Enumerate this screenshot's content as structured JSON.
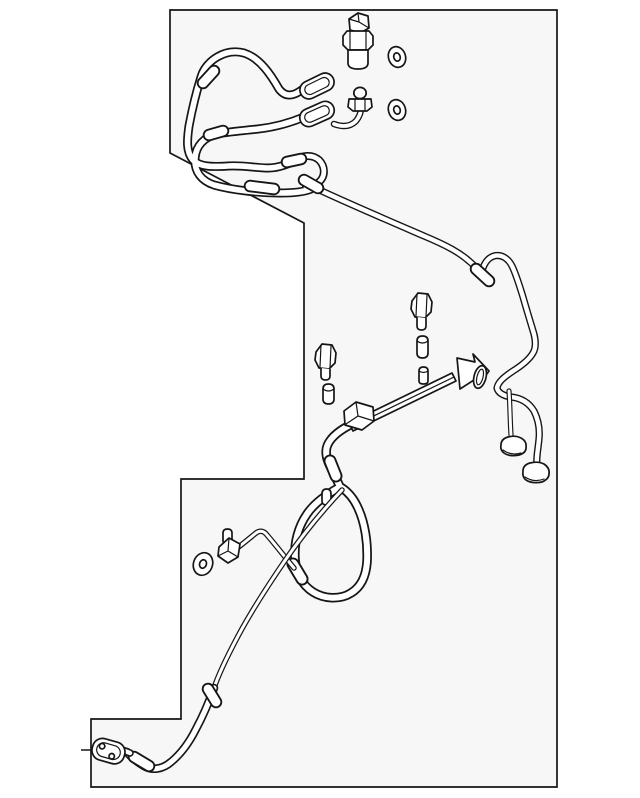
{
  "diagram": {
    "label": "Automotive air-conditioning refrigerant line assembly parts line drawing",
    "kind": "parts-line-drawing",
    "colors": {
      "background": "#ffffff",
      "panel": "#f7f7f7",
      "line": "#161616",
      "tube_fill": "#ffffff"
    },
    "components": [
      {
        "name": "pressure-switch"
      },
      {
        "name": "o-ring-upper"
      },
      {
        "name": "o-ring-lower"
      },
      {
        "name": "service-port-valve"
      },
      {
        "name": "hose-loop-upper"
      },
      {
        "name": "hose-loop-lower"
      },
      {
        "name": "crimp-fitting-upper"
      },
      {
        "name": "crimp-fitting-lower"
      },
      {
        "name": "hose-junction"
      },
      {
        "name": "main-ac-line"
      },
      {
        "name": "mounting-hook"
      },
      {
        "name": "bracket-arrow"
      },
      {
        "name": "tube-clamp-ring"
      },
      {
        "name": "rail-tube"
      },
      {
        "name": "rail-pin"
      },
      {
        "name": "clamp-block"
      },
      {
        "name": "hex-bolt-right"
      },
      {
        "name": "hex-bolt-left"
      },
      {
        "name": "dowel-pin-right"
      },
      {
        "name": "dowel-pin-left"
      },
      {
        "name": "suction-hose"
      },
      {
        "name": "hose-coil-loop"
      },
      {
        "name": "loop-stud"
      },
      {
        "name": "branch-tube"
      },
      {
        "name": "stud-fitting"
      },
      {
        "name": "sealing-washer"
      },
      {
        "name": "return-line"
      },
      {
        "name": "end-hose"
      },
      {
        "name": "flange-fitting"
      },
      {
        "name": "connector-foot-a"
      },
      {
        "name": "connector-foot-b"
      },
      {
        "name": "boundary-tick"
      }
    ]
  }
}
